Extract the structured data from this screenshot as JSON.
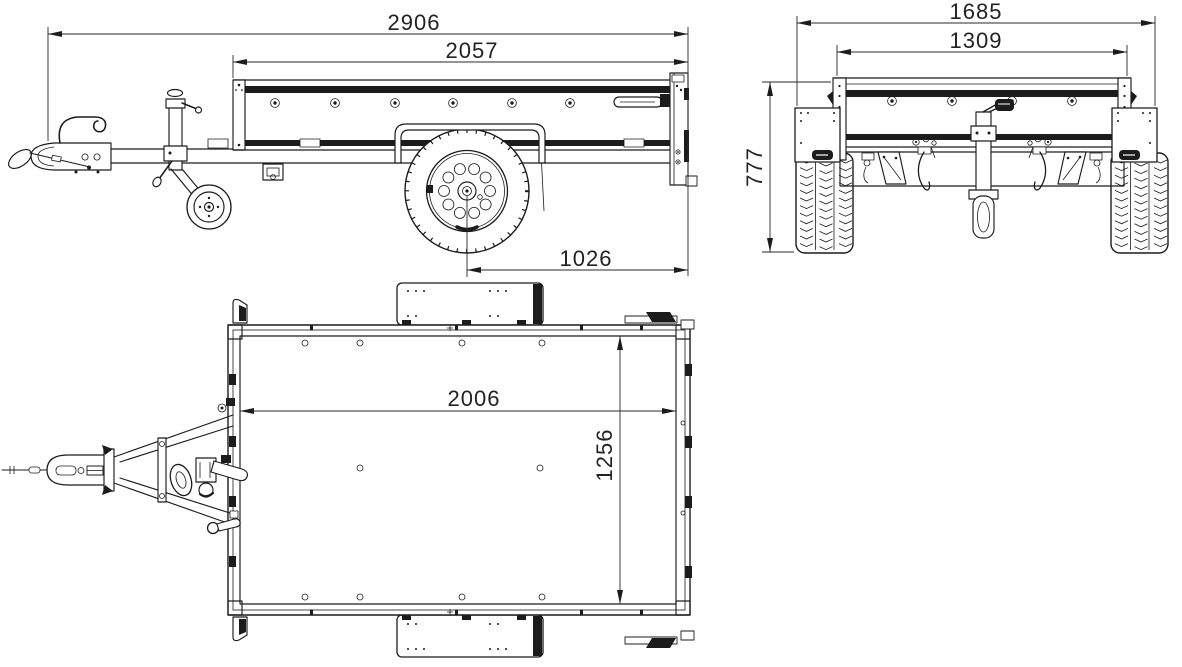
{
  "drawing": {
    "title": "trailer-three-view-dimensional-drawing",
    "colors": {
      "line": "#1c1c1c",
      "text": "#222222",
      "background": "#ffffff"
    }
  },
  "views": {
    "side": {
      "dims": {
        "overall_length": "2906",
        "box_length": "2057",
        "axle_to_rear": "1026"
      }
    },
    "rear": {
      "dims": {
        "overall_width": "1685",
        "box_inner_width": "1309",
        "height": "777"
      }
    },
    "top": {
      "dims": {
        "floor_length": "2006",
        "floor_width": "1256"
      }
    }
  }
}
